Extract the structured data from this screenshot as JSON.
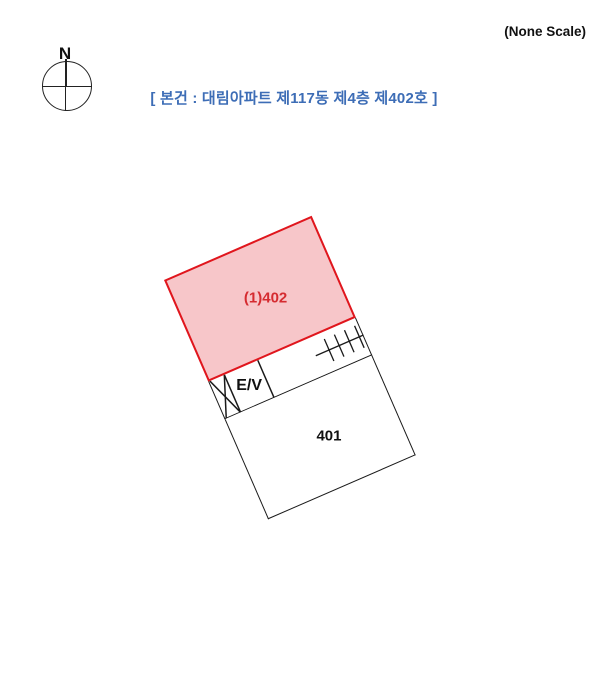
{
  "header": {
    "scale_note": "(None Scale)",
    "title": "[ 본건 : 대림아파트 제117동 제4층 제402호 ]",
    "title_color": "#3d6db6"
  },
  "compass": {
    "north_label": "N"
  },
  "floor_plan": {
    "subject_unit_label": "(1)402",
    "elevator_label": "E/V",
    "adjacent_unit_label": "401",
    "stair_symbol": "stairs-hatch",
    "shaft_symbol": "x-cross-shaft",
    "rotation_deg": -23.5,
    "colors": {
      "subject_fill": "#f7c6c9",
      "subject_line": "#e0161d",
      "subject_text": "#d52b30",
      "outline": "#1a1a1a"
    }
  }
}
